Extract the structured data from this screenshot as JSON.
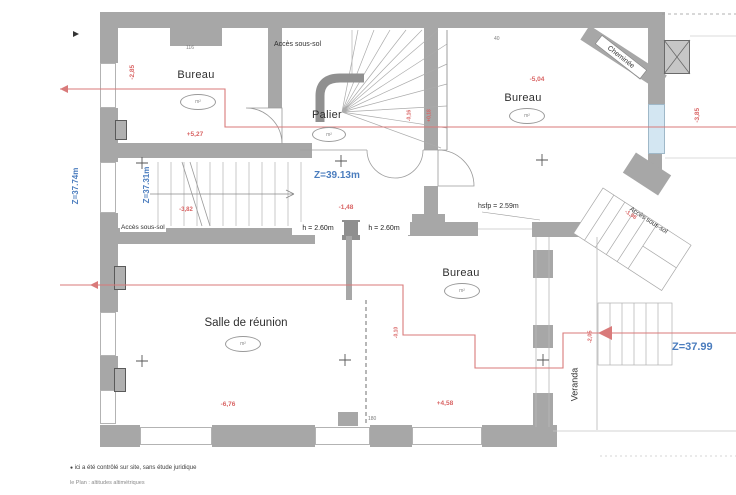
{
  "colors": {
    "wall": "#a7a7a7",
    "wall_dark": "#8f8f8f",
    "red": "#d96464",
    "blue": "#4b7dbe",
    "glass": "#d3e6f2"
  },
  "rooms": {
    "bureau_nw": {
      "label": "Bureau",
      "area": "m²"
    },
    "palier": {
      "label": "Palier",
      "area": "m²"
    },
    "bureau_ne": {
      "label": "Bureau",
      "area": "m²"
    },
    "bureau_s": {
      "label": "Bureau",
      "area": "m²"
    },
    "salle_reunion": {
      "label": "Salle de réunion",
      "area": "m²"
    },
    "veranda": {
      "label": "Veranda"
    }
  },
  "levels": {
    "palier": "Z=39.13m",
    "stair_left": "Z=37.31m",
    "left_margin": "Z=37.74m",
    "stair_right": "Z=37.99"
  },
  "heights": {
    "left": "h = 2.60m",
    "right": "h = 2.60m",
    "hsfp": "hsfp = 2.59m"
  },
  "access": {
    "top": "Accès sous-sol",
    "left": "Accès sous-sol",
    "right": "Accès sous-sol"
  },
  "labels": {
    "cheminee": "Cheminée"
  },
  "red_dims": {
    "nw_left": "-2,85",
    "nw_bottom": "+5,27",
    "ne_top": "-5,04",
    "right_edge": "-3,85",
    "stair_left": "-3,82",
    "center": "-1,48",
    "stair_right": "-1,98",
    "salle_bottom": "-6,76",
    "bureau_s_bottom": "+4,58",
    "partition": "-0,10",
    "veranda": "-2,05",
    "palier_right_a": "-0,16",
    "palier_right_b": "+0,18"
  },
  "black_dims": {
    "top_wall": "116",
    "ne_corner": "40",
    "bottom_wall": "180"
  },
  "footer": {
    "bullet": "●",
    "line1": "ici a été contrôlé sur site, sans étude juridique",
    "line2": "le Plan : altitudes altimétriques"
  }
}
